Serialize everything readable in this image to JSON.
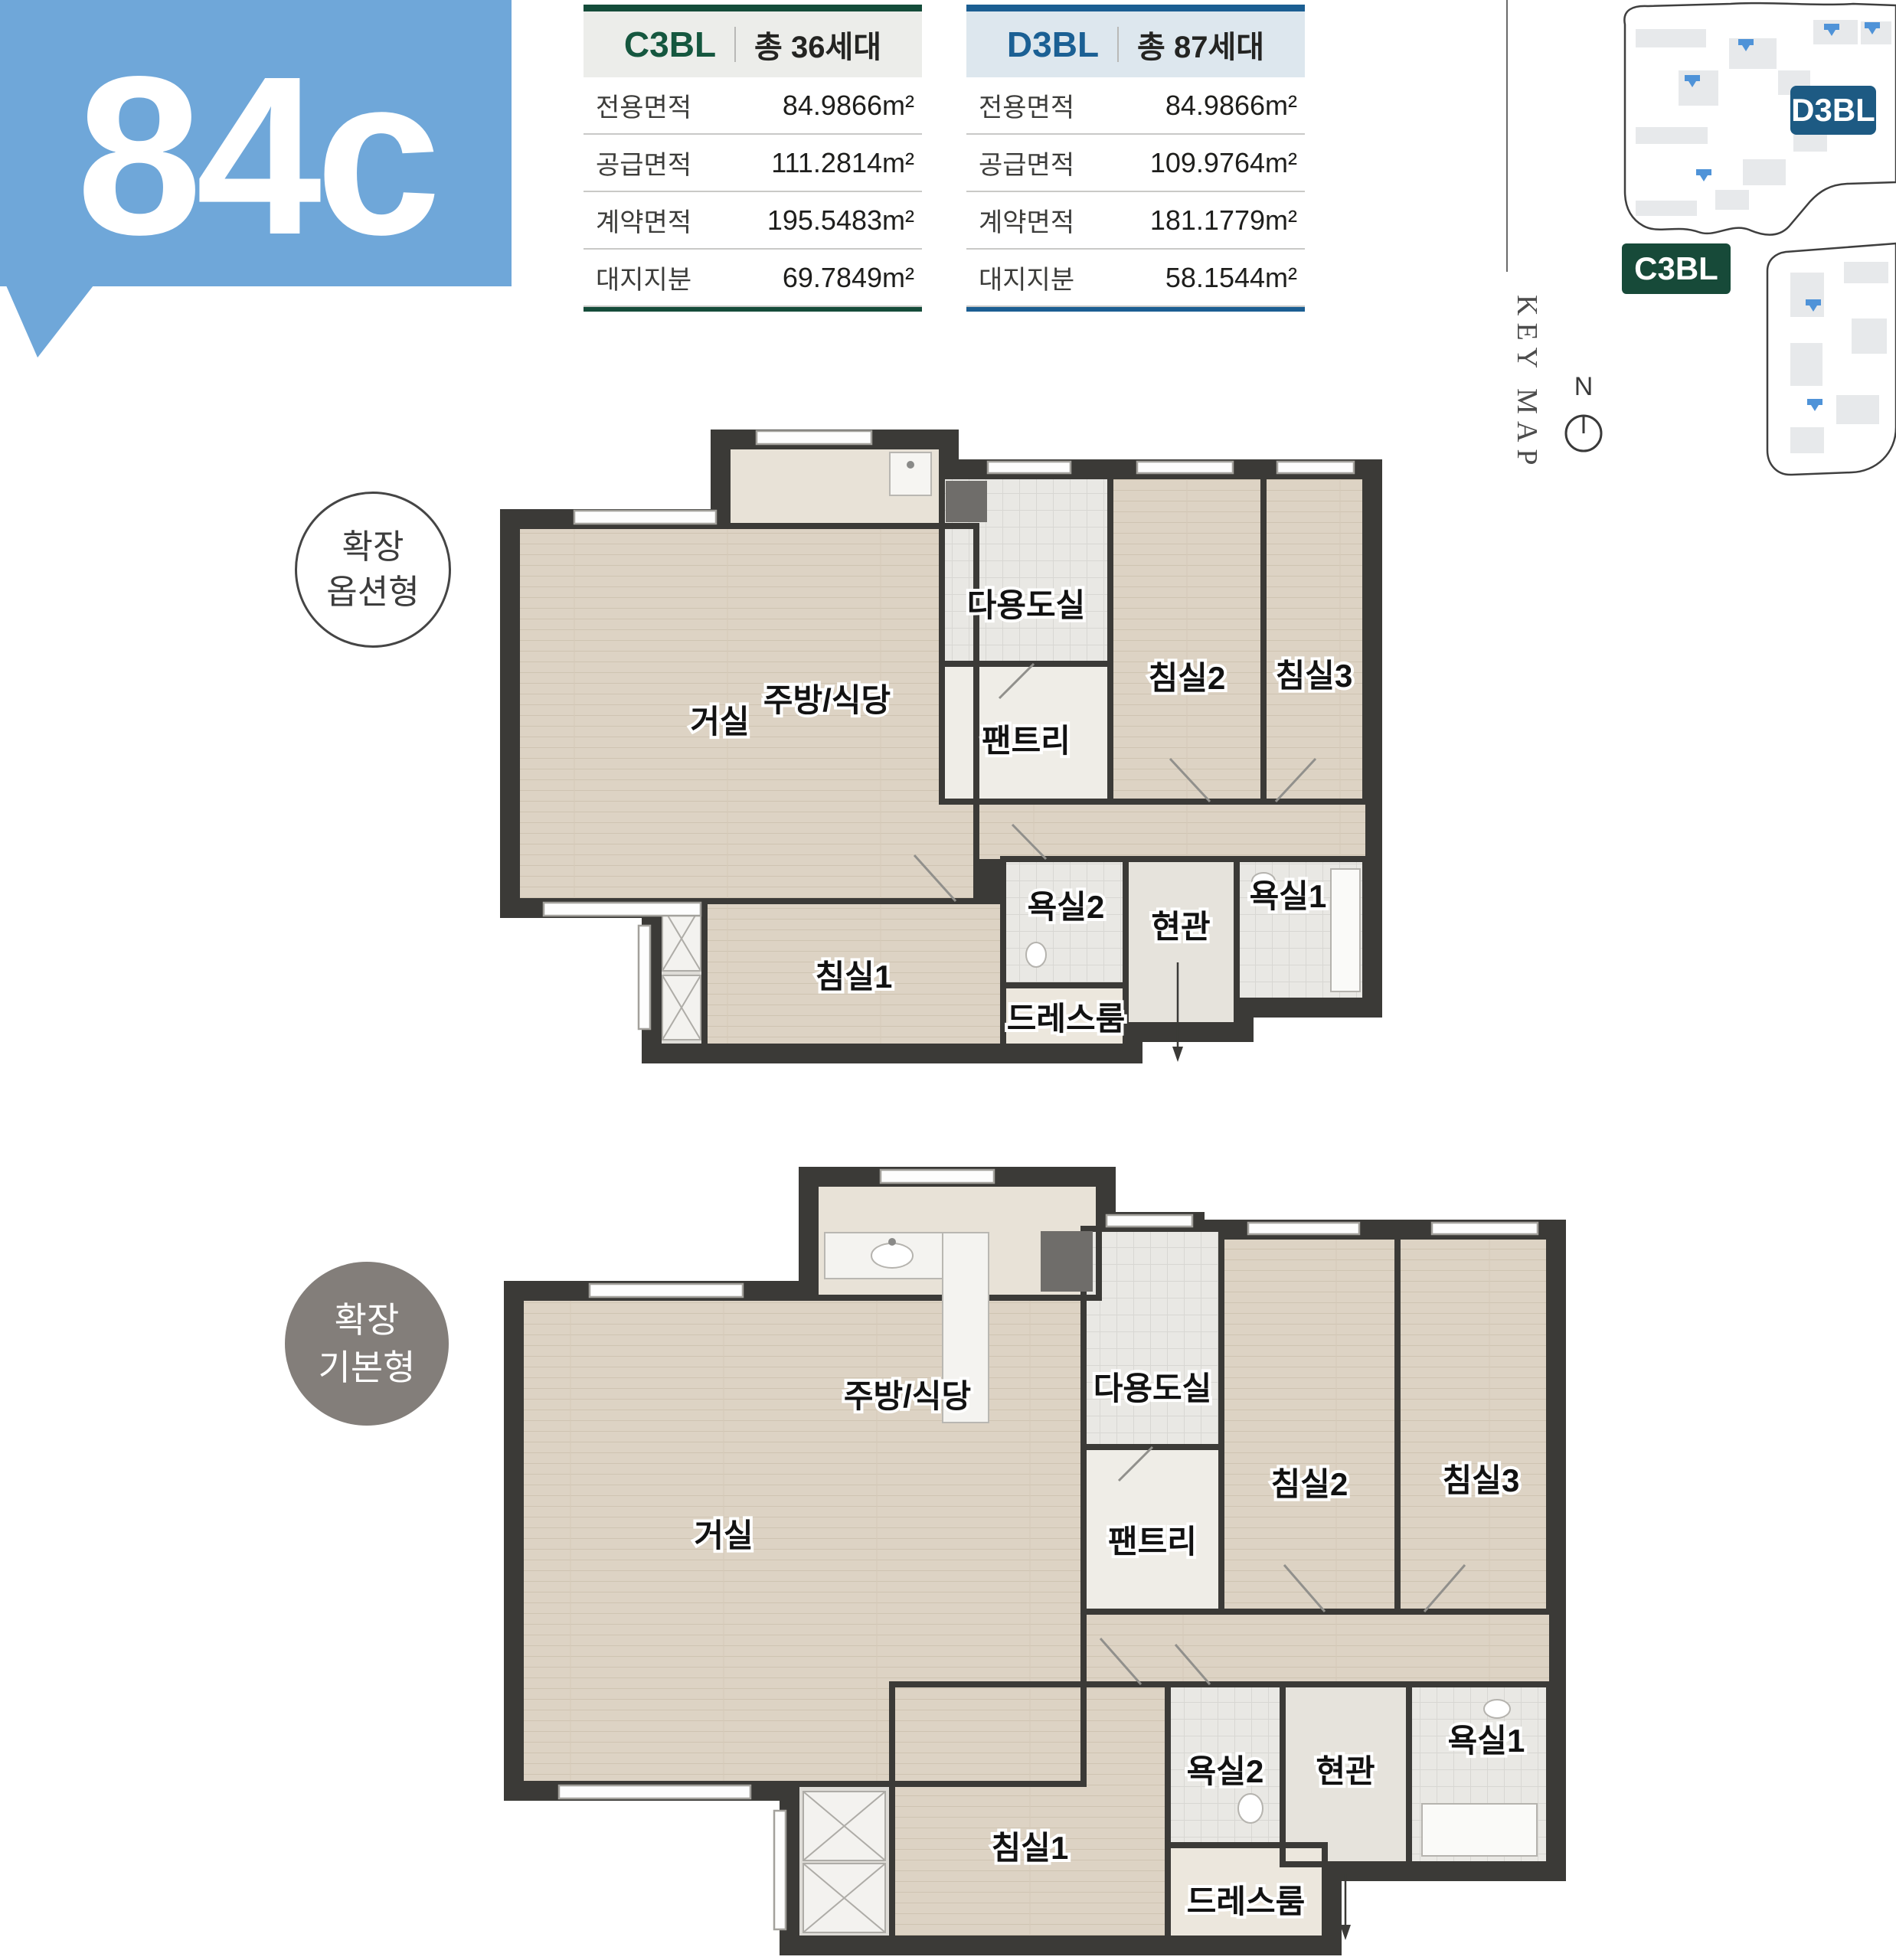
{
  "badge": {
    "label": "84c"
  },
  "spec_tables": [
    {
      "block": "C3BL",
      "total_units": "총 36세대",
      "rows": [
        {
          "label": "전용면적",
          "value": "84.9866m²"
        },
        {
          "label": "공급면적",
          "value": "111.2814m²"
        },
        {
          "label": "계약면적",
          "value": "195.5483m²"
        },
        {
          "label": "대지지분",
          "value": "69.7849m²"
        }
      ]
    },
    {
      "block": "D3BL",
      "total_units": "총 87세대",
      "rows": [
        {
          "label": "전용면적",
          "value": "84.9866m²"
        },
        {
          "label": "공급면적",
          "value": "109.9764m²"
        },
        {
          "label": "계약면적",
          "value": "181.1779m²"
        },
        {
          "label": "대지지분",
          "value": "58.1544m²"
        }
      ]
    }
  ],
  "keymap": {
    "title": "KEY MAP",
    "compass_label": "N",
    "block_labels": [
      {
        "text": "D3BL",
        "bg": "#1d5a83"
      },
      {
        "text": "C3BL",
        "bg": "#174a39"
      }
    ]
  },
  "plans": [
    {
      "type_badge": [
        "확장",
        "옵션형"
      ],
      "rooms": [
        {
          "label": "거실"
        },
        {
          "label": "주방/식당"
        },
        {
          "label": "다용도실"
        },
        {
          "label": "팬트리"
        },
        {
          "label": "침실2"
        },
        {
          "label": "침실3"
        },
        {
          "label": "욕실1"
        },
        {
          "label": "현관"
        },
        {
          "label": "욕실2"
        },
        {
          "label": "침실1"
        },
        {
          "label": "드레스룸"
        }
      ]
    },
    {
      "type_badge": [
        "확장",
        "기본형"
      ],
      "rooms": [
        {
          "label": "거실"
        },
        {
          "label": "주방/식당"
        },
        {
          "label": "다용도실"
        },
        {
          "label": "팬트리"
        },
        {
          "label": "침실2"
        },
        {
          "label": "침실3"
        },
        {
          "label": "욕실1"
        },
        {
          "label": "현관"
        },
        {
          "label": "욕실2"
        },
        {
          "label": "침실1"
        },
        {
          "label": "드레스룸"
        }
      ]
    }
  ],
  "colors": {
    "badge_blue": "#6fa7d9",
    "c3bl_green": "#144c3a",
    "d3bl_blue": "#1b5e92",
    "circle_gray": "#837e7a",
    "wall": "#3b3a37",
    "floor": "#ddd3c4",
    "marker_blue": "#4f93d8"
  }
}
